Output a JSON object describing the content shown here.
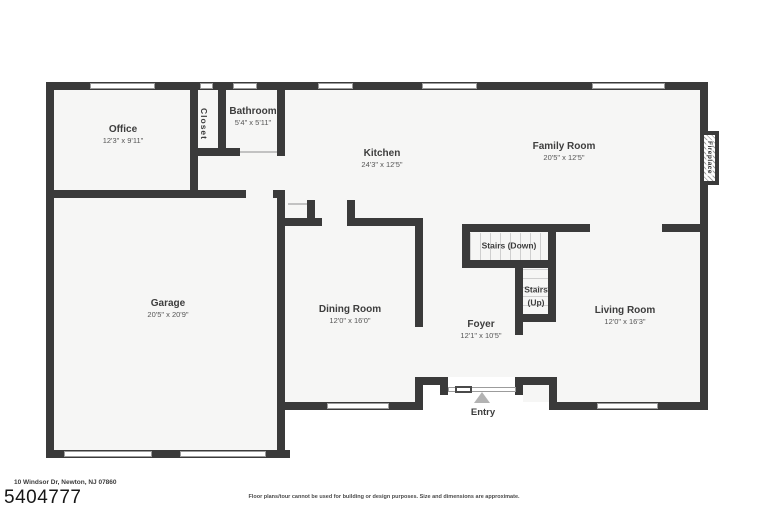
{
  "rooms": {
    "office": {
      "name": "Office",
      "dims": "12'3\" x 9'11\""
    },
    "closet": {
      "name": "Closet"
    },
    "bathroom": {
      "name": "Bathroom",
      "dims": "5'4\" x 5'11\""
    },
    "kitchen": {
      "name": "Kitchen",
      "dims": "24'3\" x 12'5\""
    },
    "family_room": {
      "name": "Family Room",
      "dims": "20'5\" x 12'5\""
    },
    "garage": {
      "name": "Garage",
      "dims": "20'5\" x 20'9\""
    },
    "dining_room": {
      "name": "Dining Room",
      "dims": "12'0\" x 16'0\""
    },
    "foyer": {
      "name": "Foyer",
      "dims": "12'1\" x 10'5\""
    },
    "living_room": {
      "name": "Living Room",
      "dims": "12'0\" x 16'3\""
    }
  },
  "stairs": {
    "down": "Stairs (Down)",
    "up_line1": "Stairs",
    "up_line2": "(Up)"
  },
  "features": {
    "fireplace": "Fireplace",
    "entry": "Entry"
  },
  "footer": {
    "address": "10 Windsor Dr, Newton, NJ 07860",
    "photo_id": "5404777",
    "disclaimer": "Floor plans/tour cannot be used for building or design purposes. Size and dimensions are approximate."
  },
  "colors": {
    "wall": "#3a3a3a",
    "floor": "#f6f6f5",
    "tread_line": "#cfcfcf",
    "window_border": "#9c9c9c",
    "entry_marker": "#b3b3b3",
    "label_text": "#3d3d3d"
  }
}
